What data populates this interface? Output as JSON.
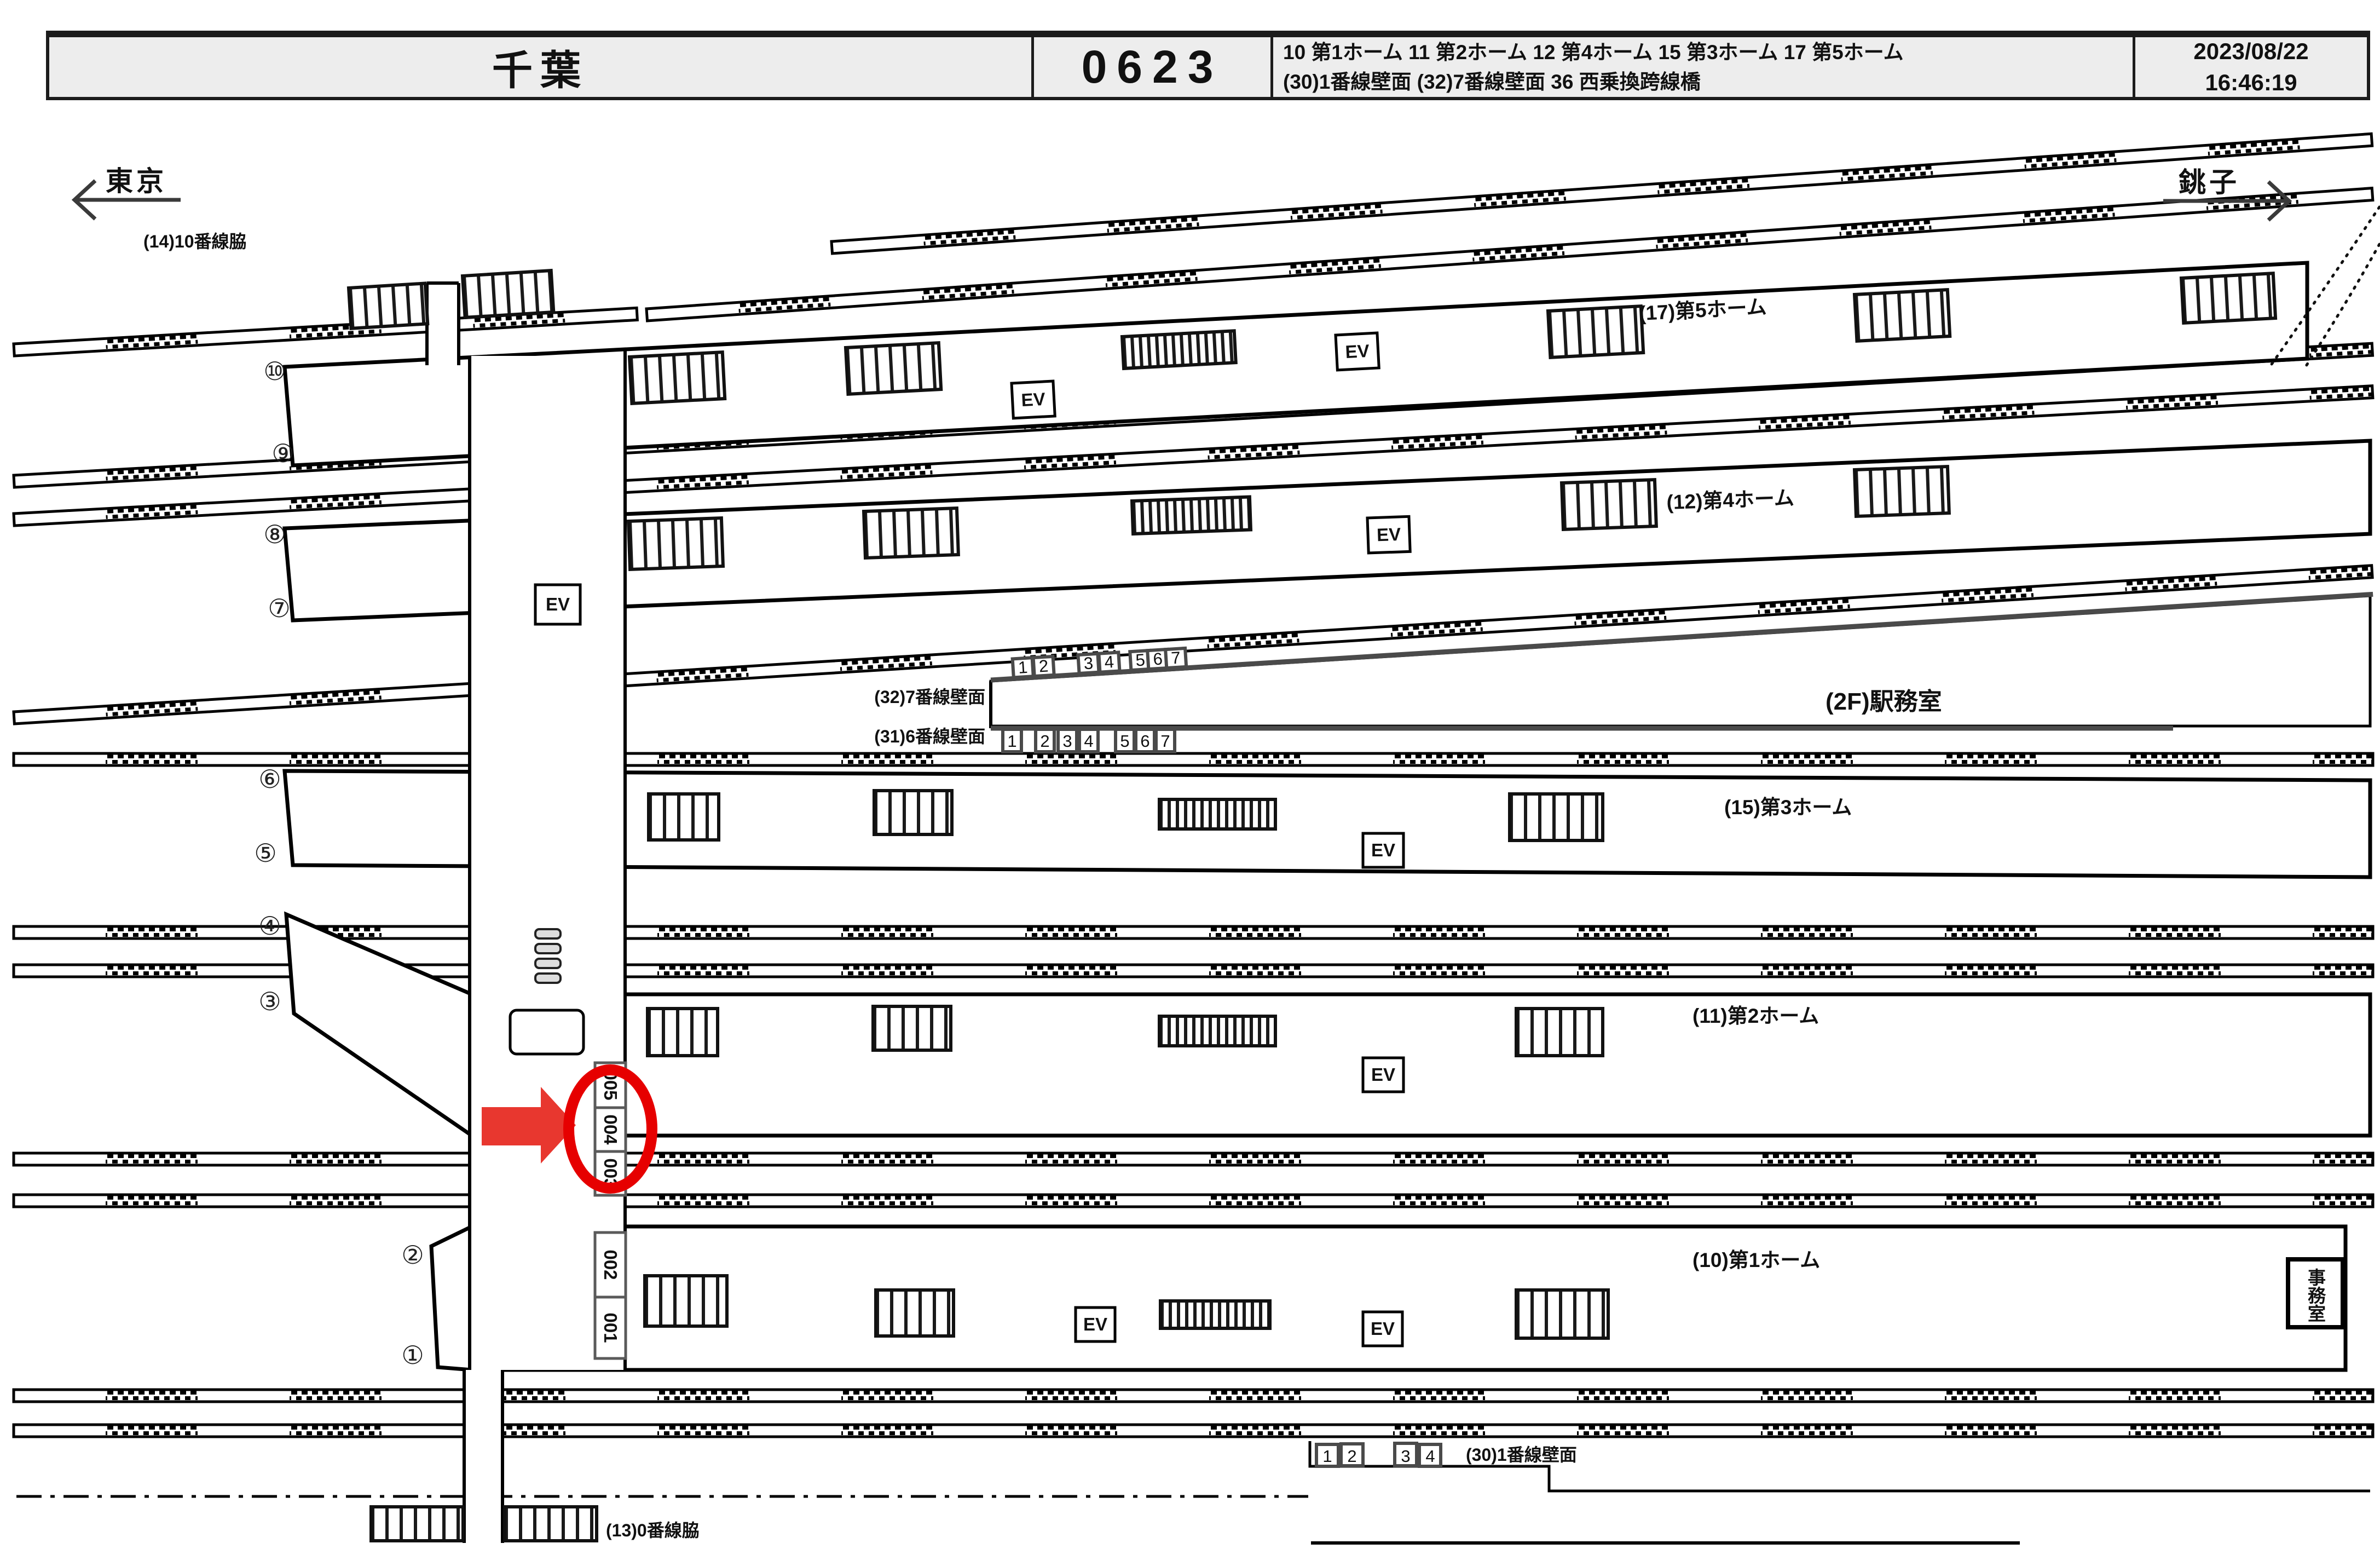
{
  "header": {
    "station": "千葉",
    "board_number": "0623",
    "legend_line1": "10 第1ホーム  11 第2ホーム  12 第4ホーム 15 第3ホーム  17 第5ホーム",
    "legend_line2": "(30)1番線壁面  (32)7番線壁面  36 西乗換跨線橋",
    "date": "2023/08/22",
    "time": "16:46:19"
  },
  "directions": {
    "west": "東京",
    "east": "銚子"
  },
  "labels": {
    "platform5": "(17)第5ホーム",
    "platform4": "(12)第4ホーム",
    "platform3": "(15)第3ホーム",
    "platform2": "(11)第2ホーム",
    "platform1": "(10)第1ホーム",
    "wall7": "(32)7番線壁面",
    "wall6": "(31)6番線壁面",
    "wall1": "(30)1番線壁面",
    "station_office_2f": "(2F)駅務室",
    "office_room": "事務室",
    "track10_side": "(14)10番線脇",
    "track0_side": "(13)0番線脇",
    "ev": "EV"
  },
  "circled_numbers": [
    "①",
    "②",
    "③",
    "④",
    "⑤",
    "⑥",
    "⑦",
    "⑧",
    "⑨",
    "⑩"
  ],
  "wall7_boxes": [
    "1",
    "2",
    "3",
    "4",
    "5",
    "6",
    "7"
  ],
  "wall6_boxes": [
    "1",
    "2",
    "3",
    "4",
    "5",
    "6",
    "7"
  ],
  "wall1_boxes": [
    "1",
    "2",
    "3",
    "4"
  ],
  "bridge_positions": [
    "005",
    "004",
    "003",
    "002",
    "001"
  ],
  "highlight": {
    "selected_position": "004"
  },
  "colors": {
    "arrow_red": "#e8372f",
    "circle_red": "#e60000",
    "header_bg": "#ededed",
    "ink": "#111111"
  }
}
